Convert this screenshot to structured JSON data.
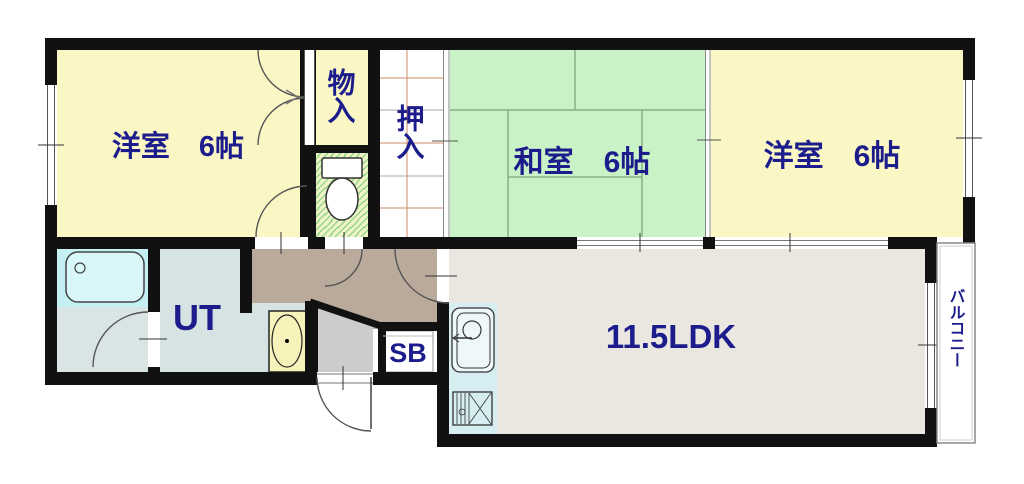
{
  "floorplan": {
    "title": "apartment-floor-plan",
    "labels": {
      "bedroom_left": "洋室　6帖",
      "storage": "物入",
      "closet": "押入",
      "japanese_room": "和室　6帖",
      "bedroom_right": "洋室　6帖",
      "utility": "UT",
      "shoebox": "SB",
      "living": "11.5LDK",
      "balcony": "バルコニー"
    },
    "colors": {
      "wall": "#111111",
      "room_yellow": "#faf7c4",
      "tatami_green": "#c9f2c6",
      "tatami_line": "#86b286",
      "toilet_bg": "#eef4c6",
      "toilet_hatch": "#7ccc7c",
      "closet_white": "#ffffff",
      "closet_grid": "#cc8866",
      "hallway": "#b9aa9c",
      "genkan": "#cccccc",
      "utility_room": "#d6e3e3",
      "bathroom": "#d9e5e5",
      "bathroom_wet": "#c4f0f4",
      "kitchen": "#d6eef2",
      "ldk": "#eae7e0",
      "label_text": "#1c1c8c",
      "door_line": "#555555"
    }
  }
}
